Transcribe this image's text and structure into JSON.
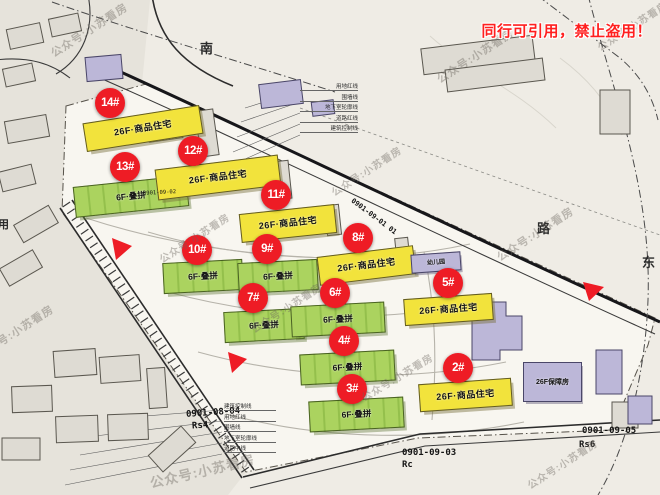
{
  "notice": "同行可引用，禁止盗用！",
  "watermark": {
    "text": "公众号:小苏看房"
  },
  "streets": {
    "south": "南",
    "road": "路",
    "east": "东",
    "left_partial": "用"
  },
  "road_code": "0901-09-01 01",
  "parcels": {
    "p0804": {
      "code": "0901-08-04",
      "zone": "Rs4"
    },
    "p0902": {
      "code": "0901-09-02"
    },
    "p0903": {
      "code": "0901-09-03",
      "zone": "Rc"
    },
    "p0905": {
      "code": "0901-09-05",
      "zone": "Rs6"
    }
  },
  "legend_top": [
    "用地红线",
    "围墙线",
    "地下室轮廓线",
    "道路红线",
    "建筑控制线"
  ],
  "legend_bottom": [
    "建筑控制线",
    "用地红线",
    "围墙线",
    "地下室轮廓线",
    "道路中线"
  ],
  "buildings": [
    {
      "badge": "14#",
      "label": "26F·商品住宅"
    },
    {
      "badge": "13#",
      "label": "6F·叠拼"
    },
    {
      "badge": "12#",
      "label": "26F·商品住宅"
    },
    {
      "badge": "11#",
      "label": "26F·商品住宅"
    },
    {
      "badge": "10#",
      "label": "6F·叠拼"
    },
    {
      "badge": "9#",
      "label": "6F·叠拼"
    },
    {
      "badge": "8#",
      "label": "26F·商品住宅"
    },
    {
      "badge": "7#",
      "label": "6F·叠拼"
    },
    {
      "badge": "6#",
      "label": "6F·叠拼"
    },
    {
      "badge": "5#",
      "label": "26F·商品住宅"
    },
    {
      "badge": "4#",
      "label": "6F·叠拼"
    },
    {
      "badge": "3#",
      "label": "6F·叠拼"
    },
    {
      "badge": "2#",
      "label": "26F·商品住宅"
    }
  ],
  "facilities": {
    "welfare": "26F保障房",
    "kindergarten": "幼儿园"
  },
  "colors": {
    "red": "#ee1c25",
    "yellow": "#f2e33c",
    "green": "#abd35f",
    "purple": "#bcb7d8",
    "notice": "#ff2020",
    "paper": "#efece5",
    "site": "#f8f6f0"
  }
}
